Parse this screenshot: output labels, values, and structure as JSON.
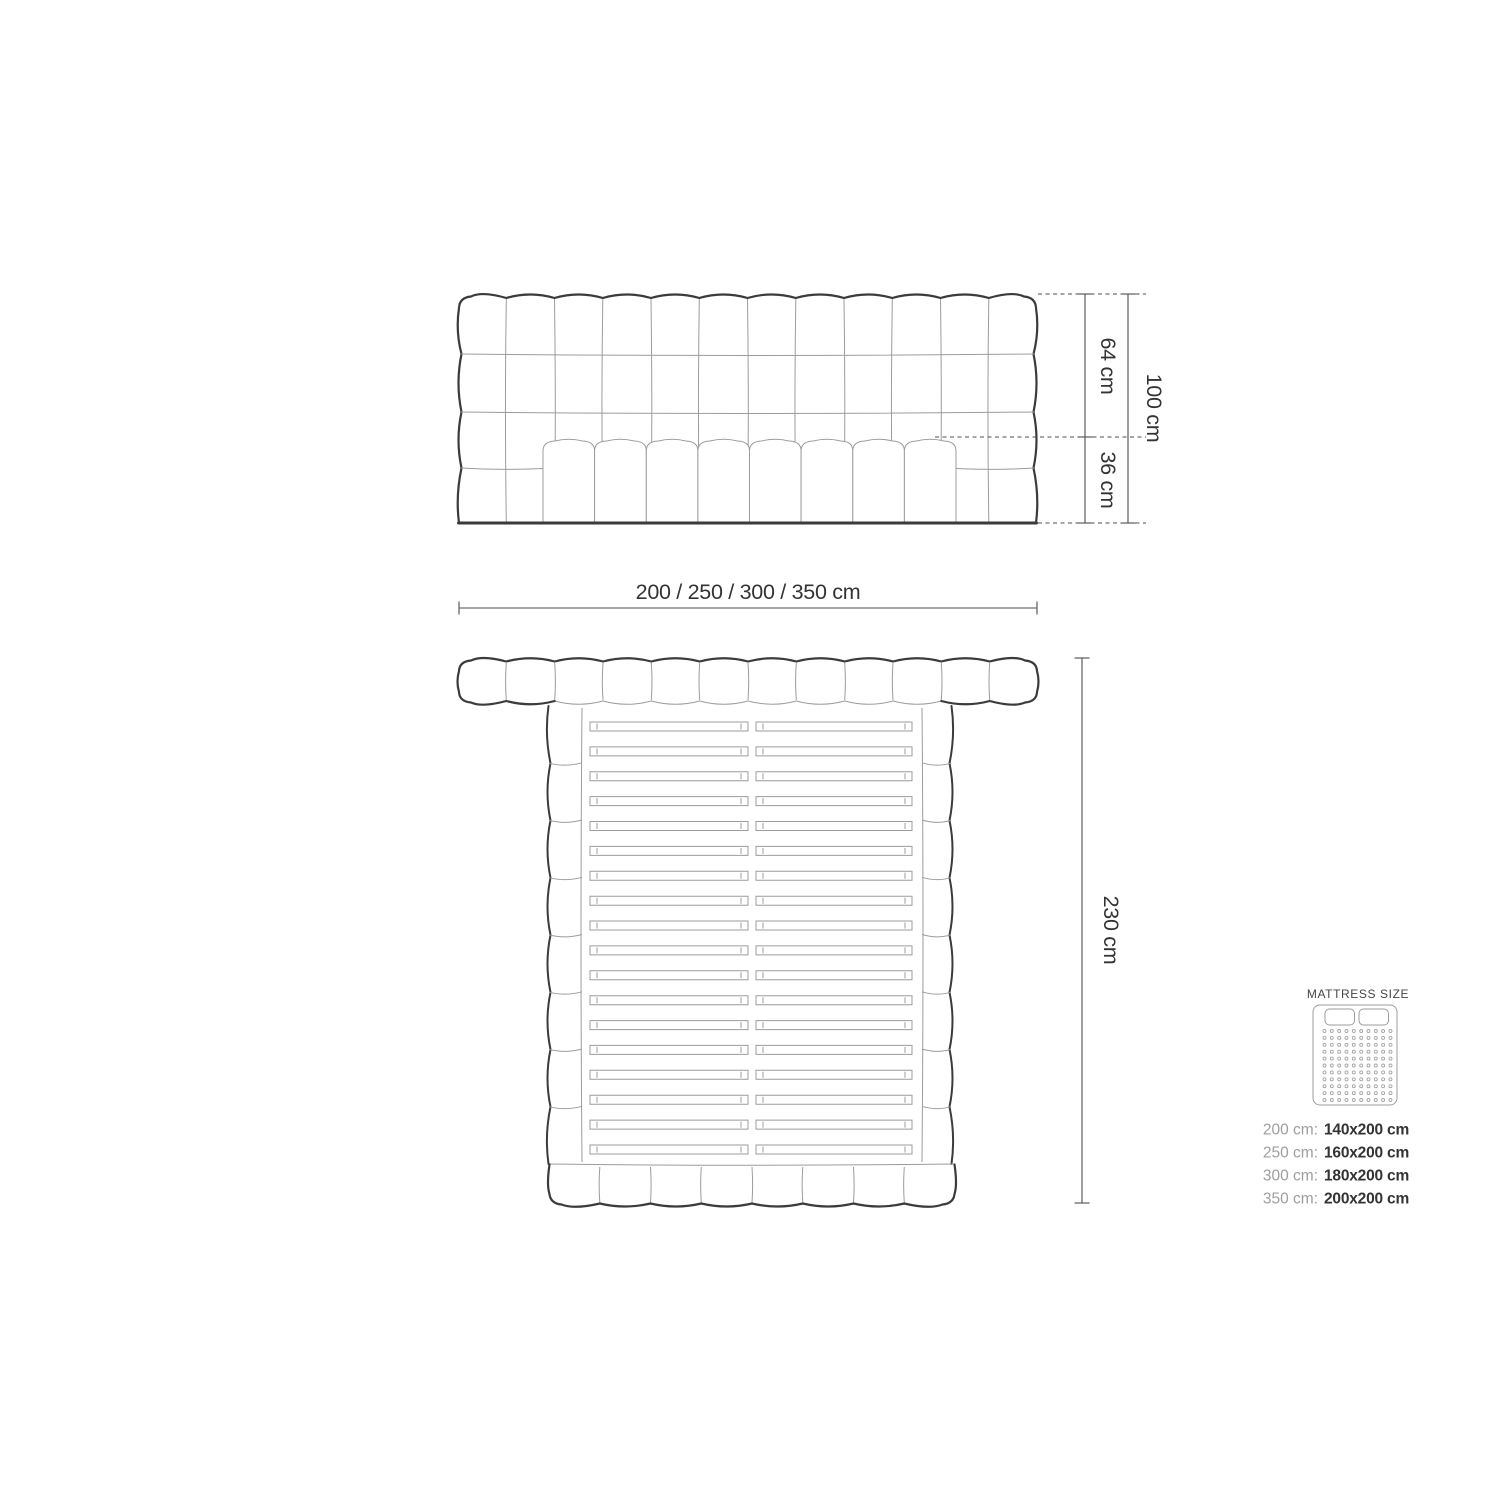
{
  "diagram": {
    "front_view": {
      "dim_upper": "64 cm",
      "dim_lower": "36 cm",
      "dim_total": "100 cm"
    },
    "width_options_label": "200 / 250 / 300 / 350 cm",
    "top_view": {
      "dim_length": "230 cm"
    },
    "mattress_panel": {
      "title": "MATTRESS SIZE",
      "sizes": [
        {
          "label": "200 cm:",
          "value": "140x200 cm"
        },
        {
          "label": "250 cm:",
          "value": "160x200 cm"
        },
        {
          "label": "300 cm:",
          "value": "180x200 cm"
        },
        {
          "label": "350 cm:",
          "value": "200x200 cm"
        }
      ]
    },
    "colors": {
      "line_bold": "#3b3b3b",
      "line_thin": "#9c9c9c",
      "dim_line": "#4d4d4d",
      "text": "#333333",
      "label_gray": "#9e9e9e",
      "background": "#ffffff"
    }
  }
}
